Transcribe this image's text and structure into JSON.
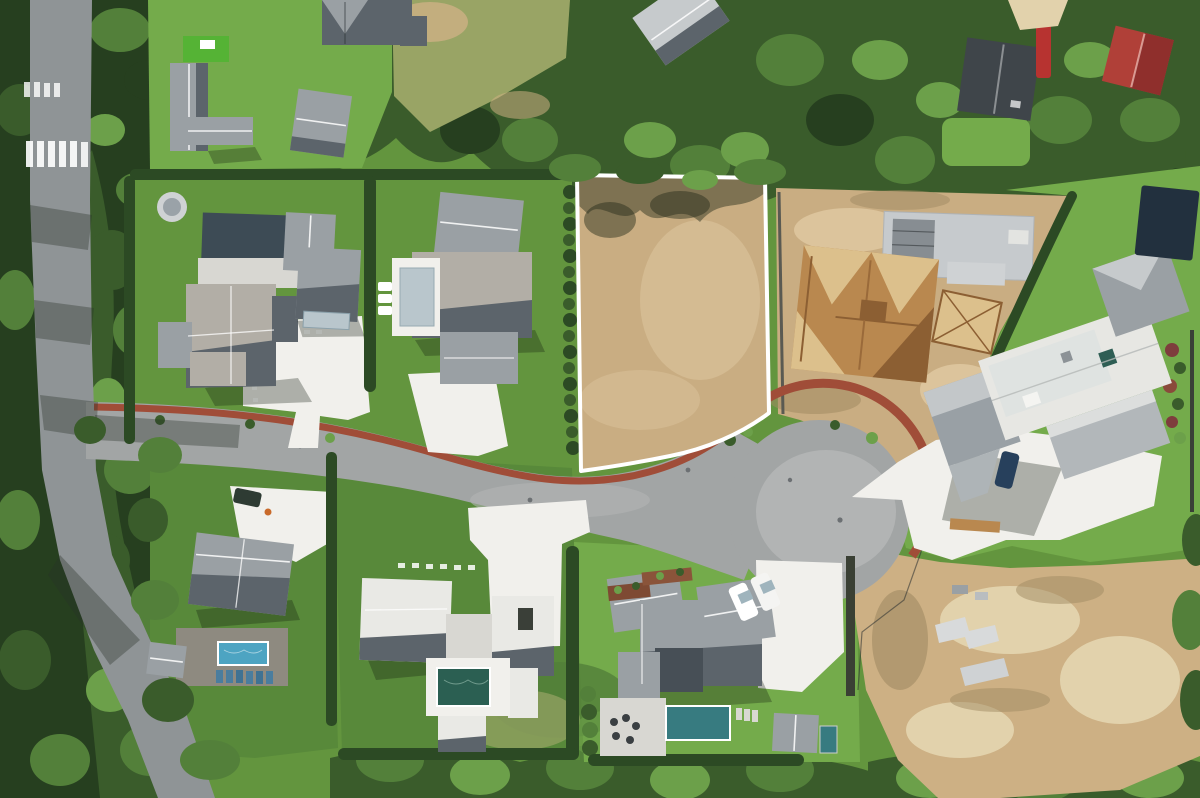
{
  "scene": {
    "description": "Aerial drone photo of a wooded luxury cul-de-sac subdivision; a vacant dirt lot in the center is highlighted with a white boundary outline; surrounding lots hold grey-roofed mansions with pools, a wood-framed house under construction, a large excavated dirt site at lower right, tree belts on all edges, and a public road with crosswalks on the left.",
    "highlighted_lot_outline_color": "#ffffff"
  },
  "palette": {
    "grassBase": "#63953e",
    "grassBright": "#74ab4b",
    "grassDeep": "#58893a",
    "meadow": "#99a465",
    "turf": "#55b335",
    "treeDark": "#263f1f",
    "treeMid": "#3a5c2b",
    "treeLight": "#53803a",
    "treeHi": "#6ca04a",
    "hedge": "#2c4a24",
    "dirt": "#c9ad82",
    "dirtLight": "#dcc49c",
    "dirtShadow": "#a08a62",
    "sand": "#cdb084",
    "sandLight": "#e2d2ac",
    "road": "#a2a5a5",
    "roadLight": "#b2b4b4",
    "roadShadow": "#8f9496",
    "brick": "#a04d38",
    "concrete": "#f1f0ec",
    "concreteShade": "#d8d7d2",
    "roofLight": "#b2aea6",
    "roofMid": "#9aa0a4",
    "roofDark": "#5c646b",
    "roofWhite": "#e9e9e5",
    "roofPale": "#c6cacc",
    "slab": "#c6cacd",
    "wood": "#b9884f",
    "woodLight": "#dcc08c",
    "woodDark": "#8c5f33",
    "poolBlue": "#4da4c2",
    "poolTeal": "#2b5f52",
    "poolCyan": "#377b80",
    "poolCover": "#22303e",
    "poolCovered": "#b9c6cc",
    "court": "#3d4b55",
    "redRoof": "#b04038",
    "redRoofDark": "#8f2f2c"
  }
}
